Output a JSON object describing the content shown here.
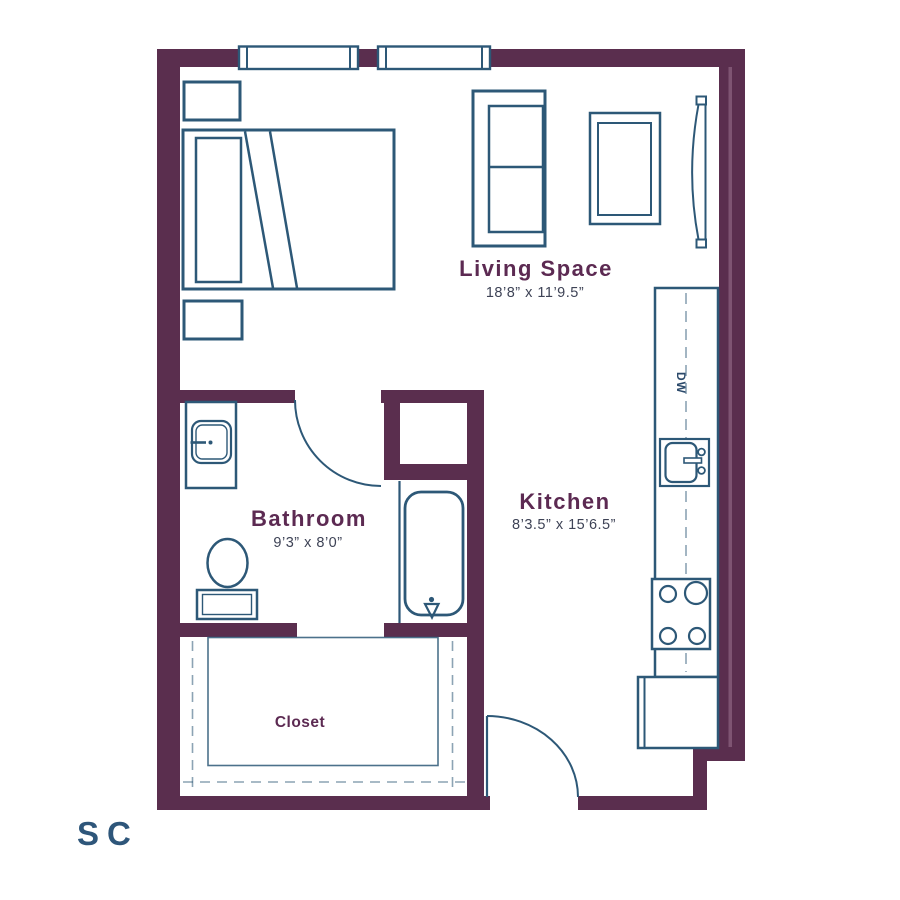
{
  "floor_plan": {
    "rooms": {
      "living_space": {
        "name": "Living Space",
        "dimensions": "18’8” x 11’9.5”"
      },
      "kitchen": {
        "name": "Kitchen",
        "dimensions": "8’3.5” x 15’6.5”"
      },
      "bathroom": {
        "name": "Bathroom",
        "dimensions": "9’3” x 8’0”"
      },
      "closet": {
        "name": "Closet"
      }
    },
    "fixtures": {
      "dishwasher_label": "DW"
    },
    "logo": {
      "text": "SC"
    },
    "colors": {
      "wall": "#5A2E4E",
      "wall-accent": "#7E5472",
      "line": "#2D5877",
      "label": "#5C2A52",
      "dim-text": "#3E4356",
      "logo": "#2E567A"
    }
  }
}
